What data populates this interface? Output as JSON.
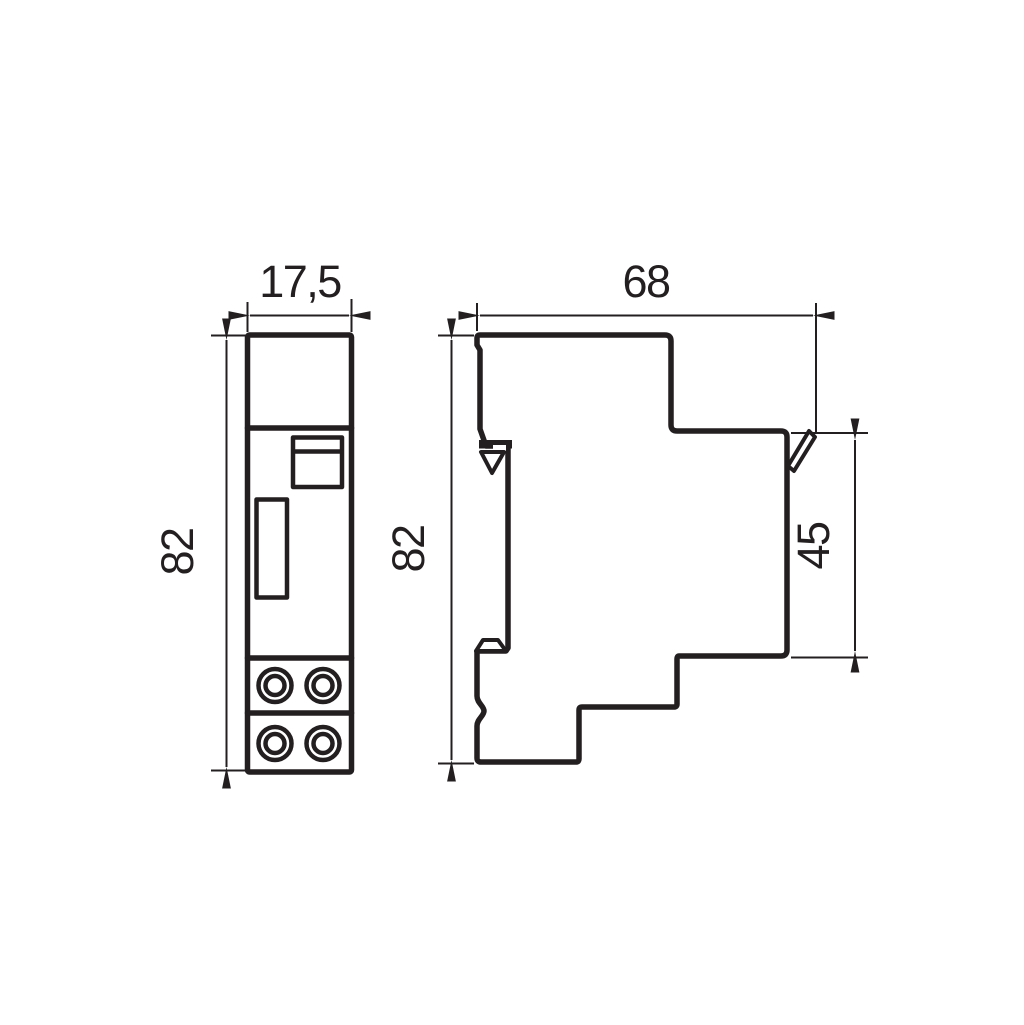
{
  "drawing": {
    "background_color": "#ffffff",
    "line_color": "#231f20",
    "front_view": {
      "width_label": "17,5",
      "height_label": "82"
    },
    "side_view": {
      "depth_label": "68",
      "height_label": "82",
      "rail_section_label": "45"
    }
  }
}
